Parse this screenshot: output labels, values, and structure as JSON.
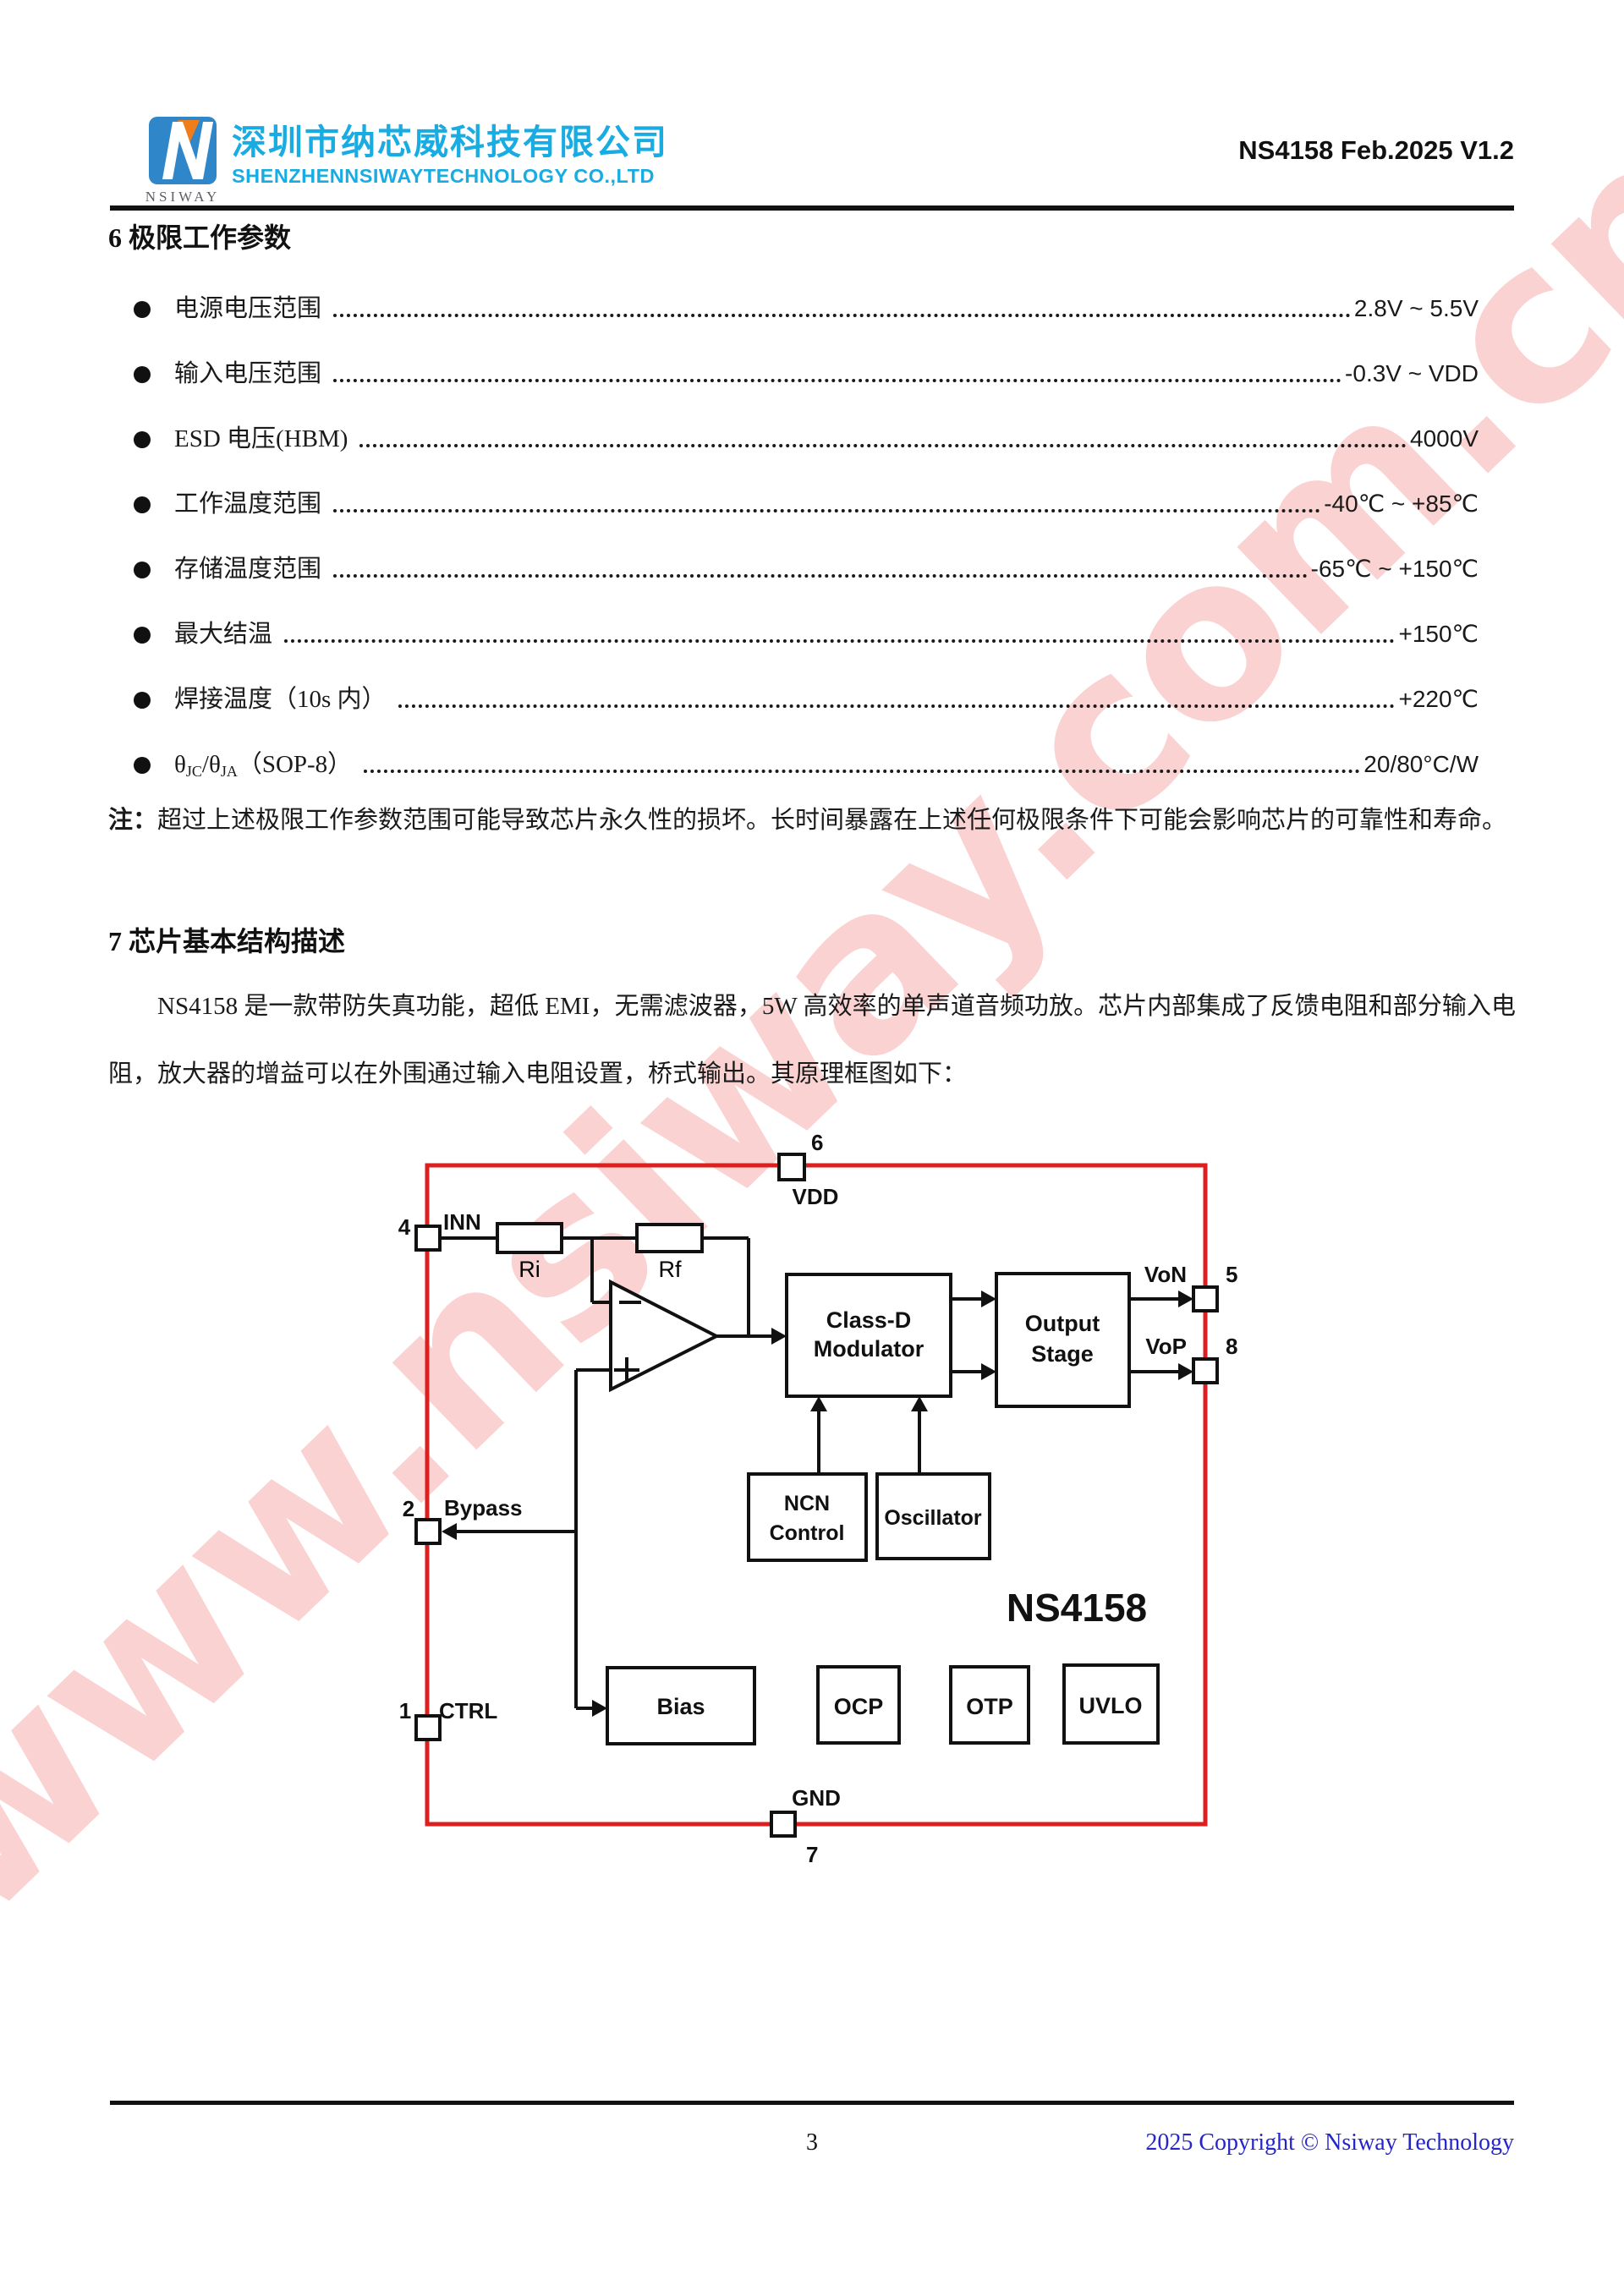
{
  "header": {
    "logo_brand": "NSIWAY",
    "company_cn": "深圳市纳芯威科技有限公司",
    "company_en": "SHENZHENNSIWAYTECHNOLOGY CO.,LTD",
    "doc_ref": "NS4158 Feb.2025 V1.2"
  },
  "section6": {
    "title": "6 极限工作参数",
    "items": [
      {
        "label": "电源电压范围",
        "value": "2.8V ~ 5.5V"
      },
      {
        "label": "输入电压范围",
        "value": "-0.3V ~ VDD"
      },
      {
        "label": "ESD 电压(HBM)",
        "value": "4000V"
      },
      {
        "label": "工作温度范围",
        "value": "-40℃ ~ +85℃"
      },
      {
        "label": "存储温度范围",
        "value": "-65℃ ~ +150℃"
      },
      {
        "label": "最大结温",
        "value": "+150℃"
      },
      {
        "label": "焊接温度（10s 内）",
        "value": "+220℃"
      },
      {
        "theta1": "θ",
        "sub1": "JC",
        "mid": "/θ",
        "sub2": "JA",
        "tail": "（SOP-8）",
        "value": "20/80°C/W"
      }
    ],
    "note_prefix": "注：",
    "note_body": "超过上述极限工作参数范围可能导致芯片永久性的损坏。长时间暴露在上述任何极限条件下可能会影响芯片的可靠性和寿命。"
  },
  "section7": {
    "title": "7 芯片基本结构描述",
    "paragraph": "NS4158 是一款带防失真功能，超低 EMI，无需滤波器，5W 高效率的单声道音频功放。芯片内部集成了反馈电阻和部分输入电阻，放大器的增益可以在外围通过输入电阻设置，桥式输出。其原理框图如下："
  },
  "diagram": {
    "chip_name": "NS4158",
    "blocks": {
      "ri": "Ri",
      "rf": "Rf",
      "classd_line1": "Class-D",
      "classd_line2": "Modulator",
      "output_line1": "Output",
      "output_line2": "Stage",
      "ncn_line1": "NCN",
      "ncn_line2": "Control",
      "oscillator": "Oscillator",
      "bias": "Bias",
      "ocp": "OCP",
      "otp": "OTP",
      "uvlo": "UVLO"
    },
    "pins": {
      "p6_num": "6",
      "p6_name": "VDD",
      "p4_num": "4",
      "p4_name": "INN",
      "p2_num": "2",
      "p2_name": "Bypass",
      "p1_num": "1",
      "p1_name": "CTRL",
      "p5_num": "5",
      "p5_name": "VoN",
      "p8_num": "8",
      "p8_name": "VoP",
      "p7_num": "7",
      "p7_name": "GND"
    },
    "colors": {
      "border": "#dd1f1f",
      "line": "#111111"
    }
  },
  "watermark_text": "www.nsiway.com.cn",
  "footer": {
    "page_number": "3",
    "copyright": "2025 Copyright © Nsiway Technology"
  }
}
